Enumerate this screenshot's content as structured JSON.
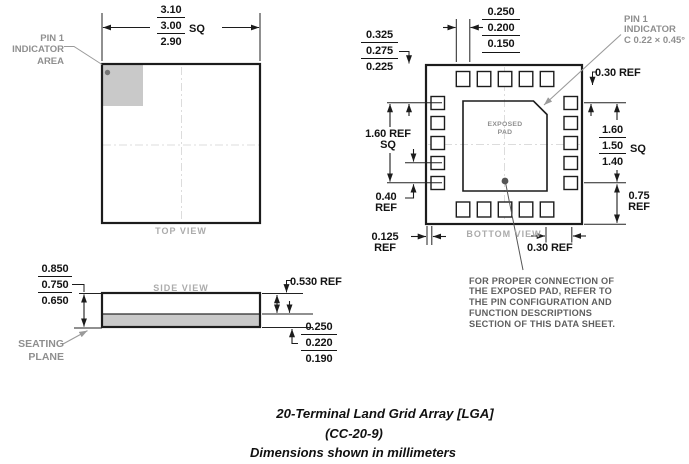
{
  "colors": {
    "line": "#1c1c1c",
    "gray_fill": "#c9c9c9",
    "gray_text": "#8f8f8f",
    "light_gray_text": "#ababab",
    "note_text": "#5f5f5f"
  },
  "title": {
    "line1": "20-Terminal Land Grid Array [LGA]",
    "line2": "(CC-20-9)",
    "line3": "Dimensions shown in millimeters"
  },
  "top_view": {
    "label": "TOP VIEW",
    "pin1_area": {
      "l1": "PIN 1",
      "l2": "INDICATOR",
      "l3": "AREA"
    },
    "size": {
      "max": "3.10",
      "typ": "3.00",
      "min": "2.90",
      "suffix": "SQ"
    }
  },
  "bottom_view": {
    "label": "BOTTOM VIEW",
    "exposed_pad": {
      "l1": "EXPOSED",
      "l2": "PAD"
    },
    "pin1_indicator": {
      "l1": "PIN 1",
      "l2": "INDICATOR",
      "l3": "C 0.22 × 0.45°"
    },
    "terminal_width": {
      "max": "0.250",
      "typ": "0.200",
      "min": "0.150"
    },
    "edge_to_pad": {
      "max": "0.325",
      "typ": "0.275",
      "min": "0.225"
    },
    "pad_span": {
      "l1": "1.60 REF",
      "l2": "SQ"
    },
    "pad_pitch": {
      "l1": "0.40",
      "l2": "REF"
    },
    "edge_clearance": {
      "l1": "0.125",
      "l2": "REF"
    },
    "top_right_offset": "0.30 REF",
    "exposed_pad_size": {
      "max": "1.60",
      "typ": "1.50",
      "min": "1.40",
      "suffix": "SQ"
    },
    "bottom_right_span": {
      "l1": "0.75",
      "l2": "REF"
    },
    "bottom_offset": "0.30 REF"
  },
  "side_view": {
    "label": "SIDE VIEW",
    "overall_height": {
      "max": "0.850",
      "typ": "0.750",
      "min": "0.650"
    },
    "mold_height": "0.530 REF",
    "substrate_thickness": {
      "max": "0.250",
      "typ": "0.220",
      "min": "0.190"
    },
    "seating_plane": {
      "l1": "SEATING",
      "l2": "PLANE"
    }
  },
  "note": {
    "lines": [
      "FOR PROPER CONNECTION OF",
      "THE EXPOSED PAD, REFER TO",
      "THE PIN CONFIGURATION AND",
      "FUNCTION DESCRIPTIONS",
      "SECTION OF THIS DATA SHEET."
    ]
  }
}
